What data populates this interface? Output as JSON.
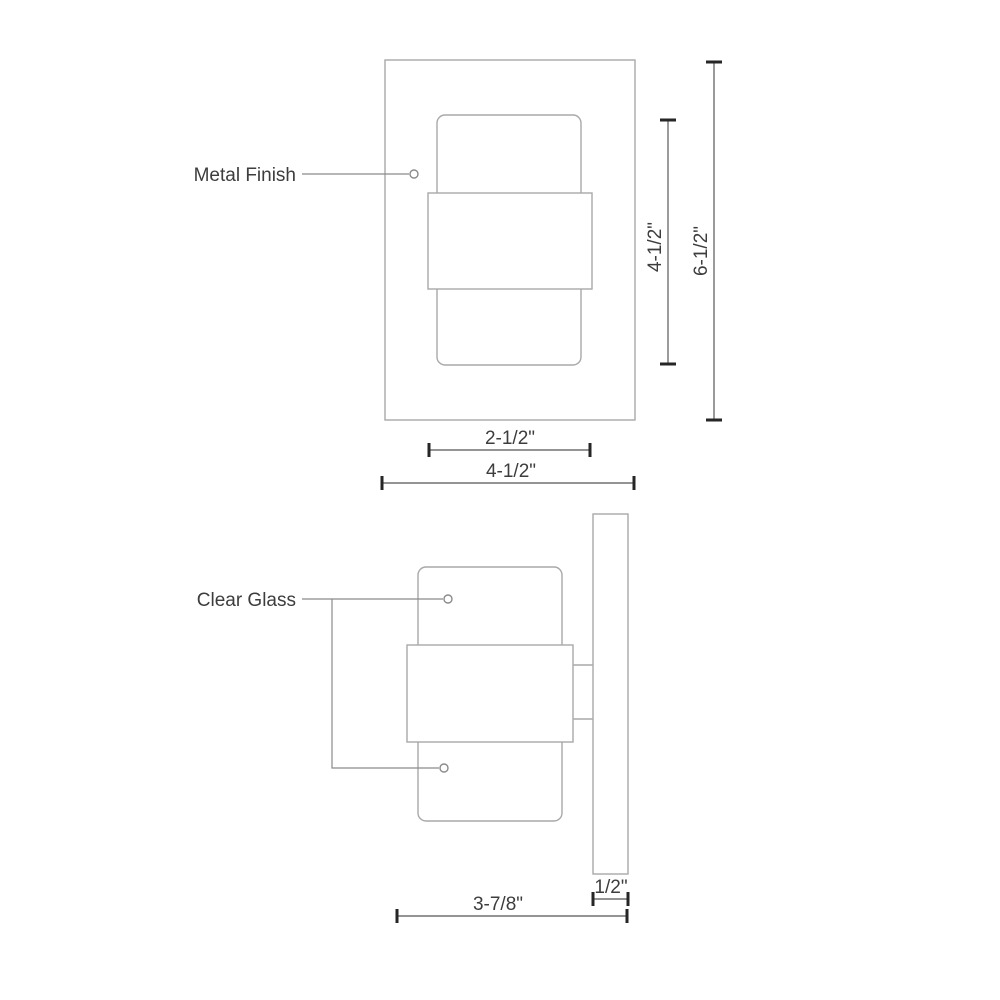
{
  "labels": {
    "metal_finish": "Metal Finish",
    "clear_glass": "Clear Glass"
  },
  "dimensions": {
    "front_view": {
      "band_width": "2-1/2\"",
      "backplate_width": "4-1/2\"",
      "glass_height": "4-1/2\"",
      "overall_height": "6-1/2\""
    },
    "side_view": {
      "extension_depth": "3-7/8\"",
      "wall_plate_thickness": "1/2\""
    }
  },
  "colors": {
    "background": "#ffffff",
    "structure_outline": "#a9a9a9",
    "dimension_line": "#707070",
    "dimension_tick": "#262626",
    "leader_line": "#8a8a8a",
    "text": "#3d3d3d"
  }
}
